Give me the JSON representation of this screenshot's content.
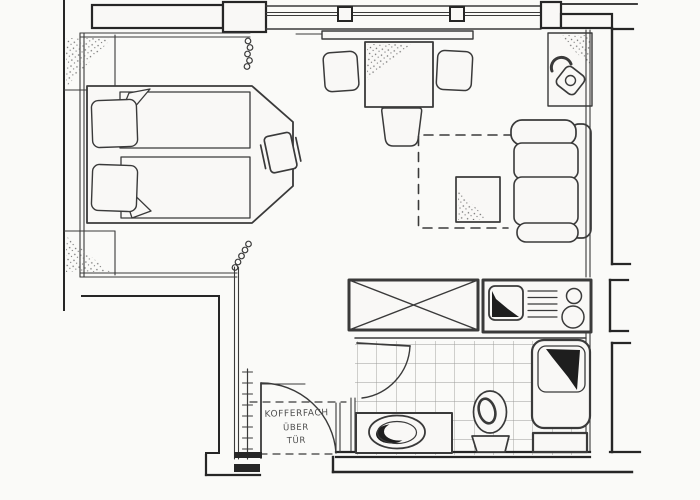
{
  "plan": {
    "door_label": {
      "line1": "KOFFERFACH",
      "line2": "ÜBER",
      "line3": "TÜR"
    }
  },
  "colors": {
    "paper": "#fafaf8",
    "furniture_fill": "#f9f8f6",
    "ink": "#3a3a3a",
    "wall_ink": "#262626",
    "tile_line": "#9a9a98",
    "shading": "#1e1e1e",
    "stipple": "#6f6f6f",
    "label_text": "#4f4f4f"
  },
  "icons": {
    "telephone": "rotary-phone-top-view",
    "curtain": "coil-spring",
    "wardrobe": "crossed-box",
    "stove": "two-burner-hob",
    "sink": "square-basin-shaded",
    "shower": "corner-shower-tray",
    "toilet": "toilet-top-view",
    "washbasin": "oval-basin-in-counter",
    "luggage_rack": "ladder-ticks",
    "door_swing": "quarter-arc"
  }
}
